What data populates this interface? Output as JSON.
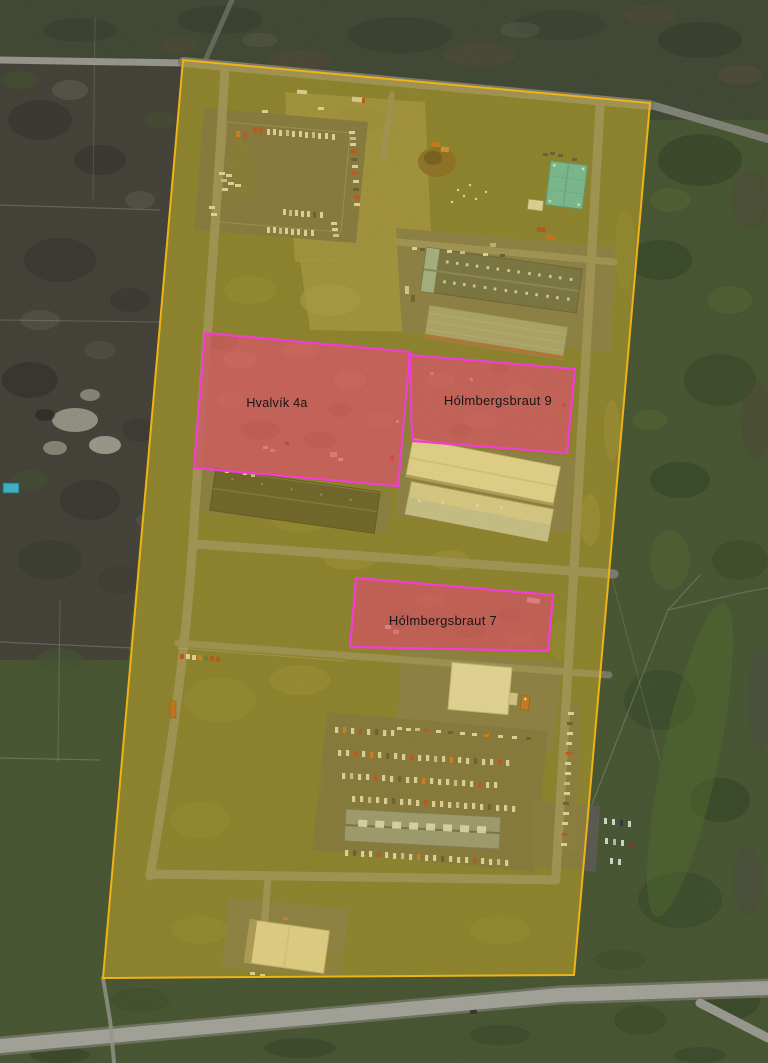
{
  "map": {
    "title": "Aerial zoning overlay map",
    "boundary": {
      "id": "site-boundary",
      "fill": "rgba(243,201,24,0.30)",
      "stroke": "#efb315"
    },
    "parcels": [
      {
        "id": "hvalvik-4a",
        "label": "Hvalvík 4a",
        "fill": "rgba(222,66,108,0.55)",
        "stroke": "#f13ed2"
      },
      {
        "id": "holmbergsbraut-9",
        "label": "Hólmbergsbraut 9",
        "fill": "rgba(222,66,108,0.55)",
        "stroke": "#f13ed2"
      },
      {
        "id": "holmbergsbraut-7",
        "label": "Hólmbergsbraut 7",
        "fill": "rgba(222,66,108,0.57)",
        "stroke": "#f13ed2"
      }
    ],
    "label_color": "#161616"
  }
}
